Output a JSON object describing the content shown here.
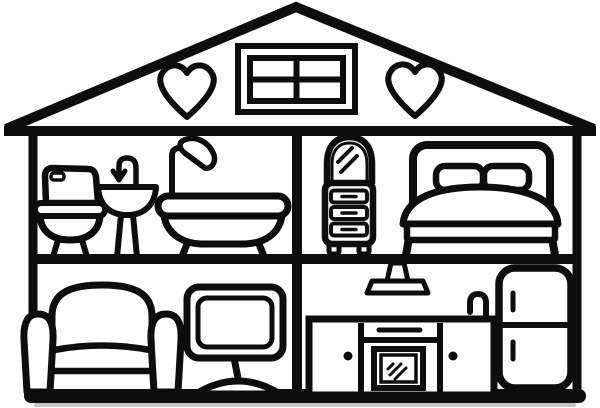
{
  "illustration": {
    "title": "Cutaway dollhouse coloring page",
    "style": "black outline line-art, no color fill",
    "colors": {
      "ink": "#0d0d0d",
      "background": "#ffffff",
      "shadow": "#c6c6c6"
    },
    "attic": {
      "label": "Attic",
      "window_label": "Four-pane attic window",
      "heart_left_label": "Heart decoration",
      "heart_right_label": "Heart decoration"
    },
    "rooms": {
      "bathroom": {
        "label": "Bathroom",
        "position": "upper-left",
        "toilet": "Toilet",
        "sink": "Pedestal sink with faucet",
        "bathtub": "Bathtub with shower head"
      },
      "bedroom": {
        "label": "Bedroom",
        "position": "upper-right",
        "dresser": "Dresser with arched mirror and three drawers",
        "bed": "Bed with headboard, two pillows and blanket"
      },
      "living_room": {
        "label": "Living room",
        "position": "lower-left",
        "armchair": "Armchair",
        "tv": "Television on pedestal stand"
      },
      "kitchen": {
        "label": "Kitchen",
        "position": "lower-right",
        "lamp": "Ceiling pendant lamp",
        "counter": "Kitchen counter with oven and cabinets",
        "faucet": "Kitchen faucet",
        "fridge": "Two-door refrigerator"
      }
    }
  }
}
